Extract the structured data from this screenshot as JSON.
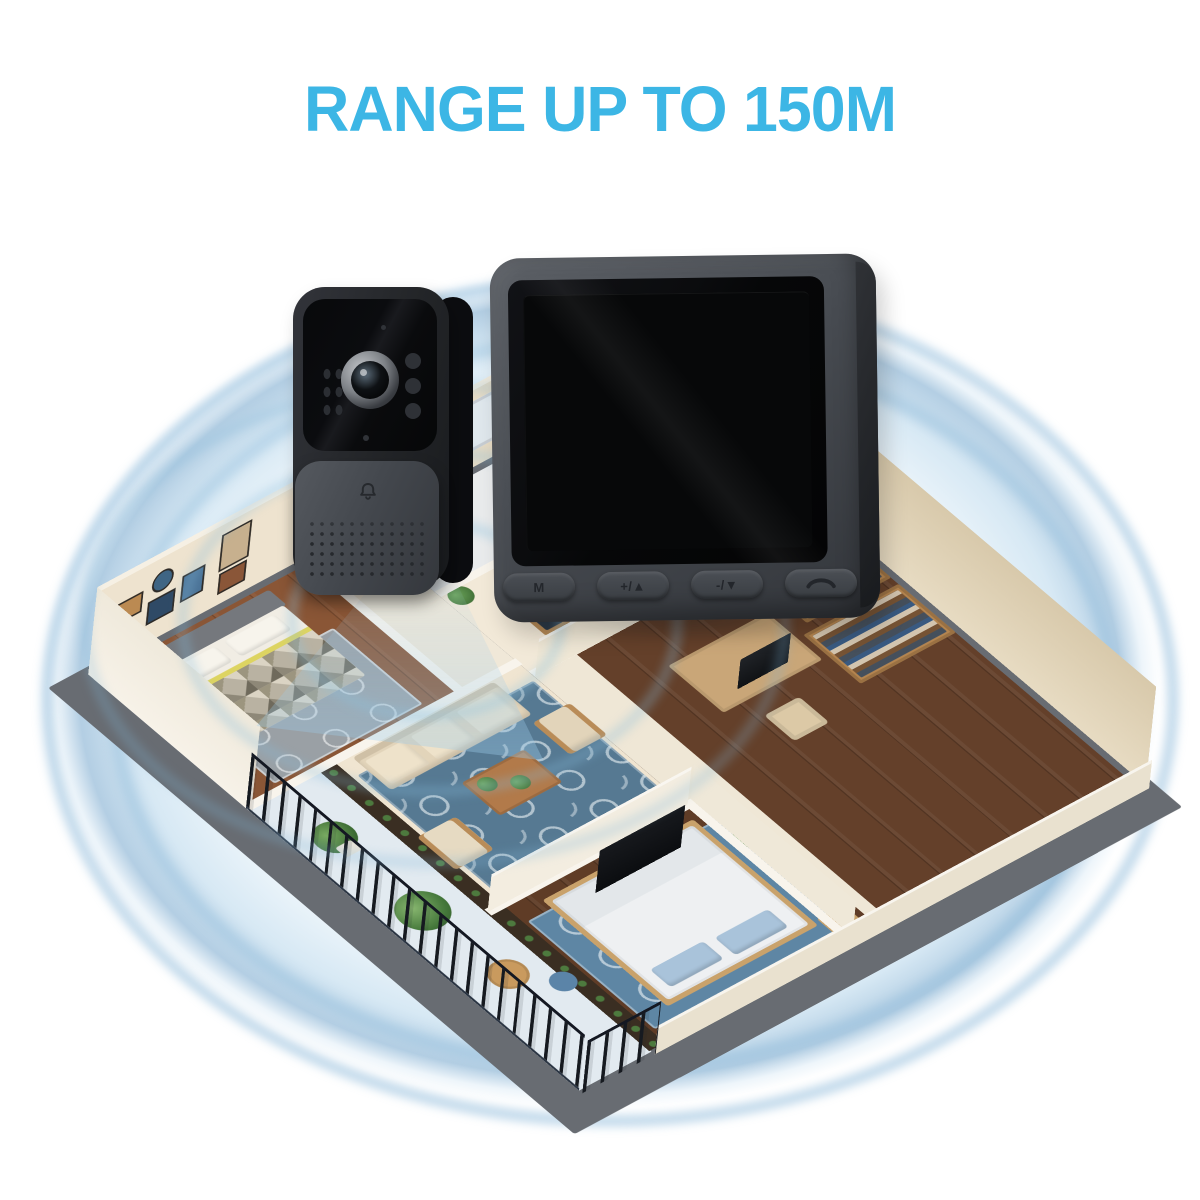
{
  "title": {
    "text": "RANGE UP TO 150M",
    "color": "#3cb6e5"
  },
  "signal": {
    "ring_color": "#649fc8",
    "rings_visible": 5
  },
  "doorbell": {
    "bell_icon": "bell-icon",
    "lens_icon": "camera-lens"
  },
  "monitor": {
    "buttons": [
      {
        "label": "M"
      },
      {
        "label": "+/▲"
      },
      {
        "label": "-/▼"
      },
      {
        "label": "",
        "icon": "phone-icon"
      }
    ]
  }
}
